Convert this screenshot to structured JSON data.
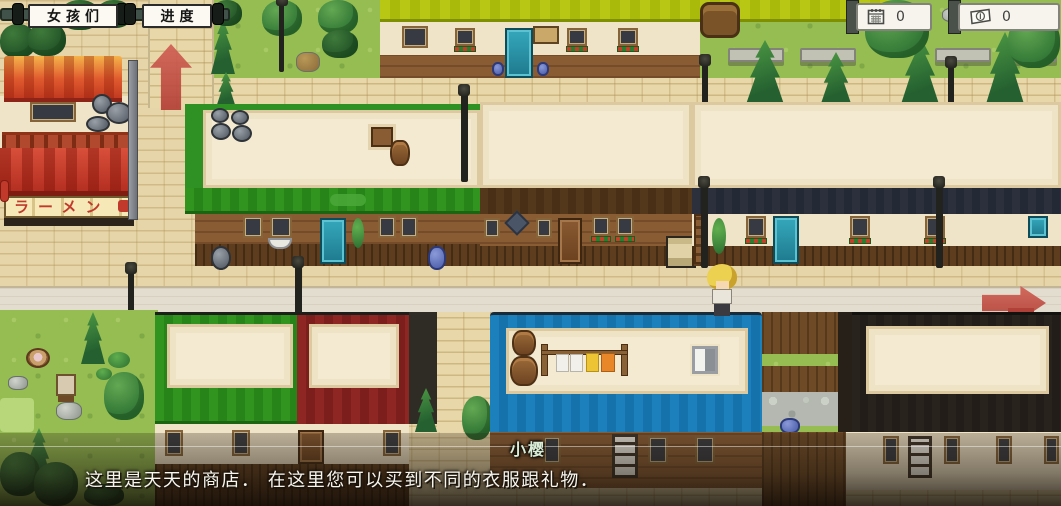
{
  "hud": {
    "girls_button": "女孩们",
    "progress_button": "进度",
    "counters": [
      {
        "name": "day-counter",
        "icon": "calendar-icon",
        "value": "0"
      },
      {
        "name": "money-counter",
        "icon": "money-icon",
        "value": "0"
      }
    ]
  },
  "map": {
    "ramen_shop_sign": "ラーメン",
    "exit_arrows": [
      {
        "icon": "up-arrow",
        "direction": "up"
      },
      {
        "icon": "right-arrow",
        "direction": "right"
      }
    ]
  },
  "dialogue": {
    "speaker": "小樱",
    "text": "这里是天天的商店． 在这里您可以买到不同的衣服跟礼物．"
  },
  "colors": {
    "arrow_red": "#c4524a",
    "roof_green": "#2f9024",
    "roof_blue": "#1879b4",
    "roof_yellow": "#b5c417",
    "roof_maroon": "#8e2723",
    "dialogue_text": "#f7f5ee"
  }
}
